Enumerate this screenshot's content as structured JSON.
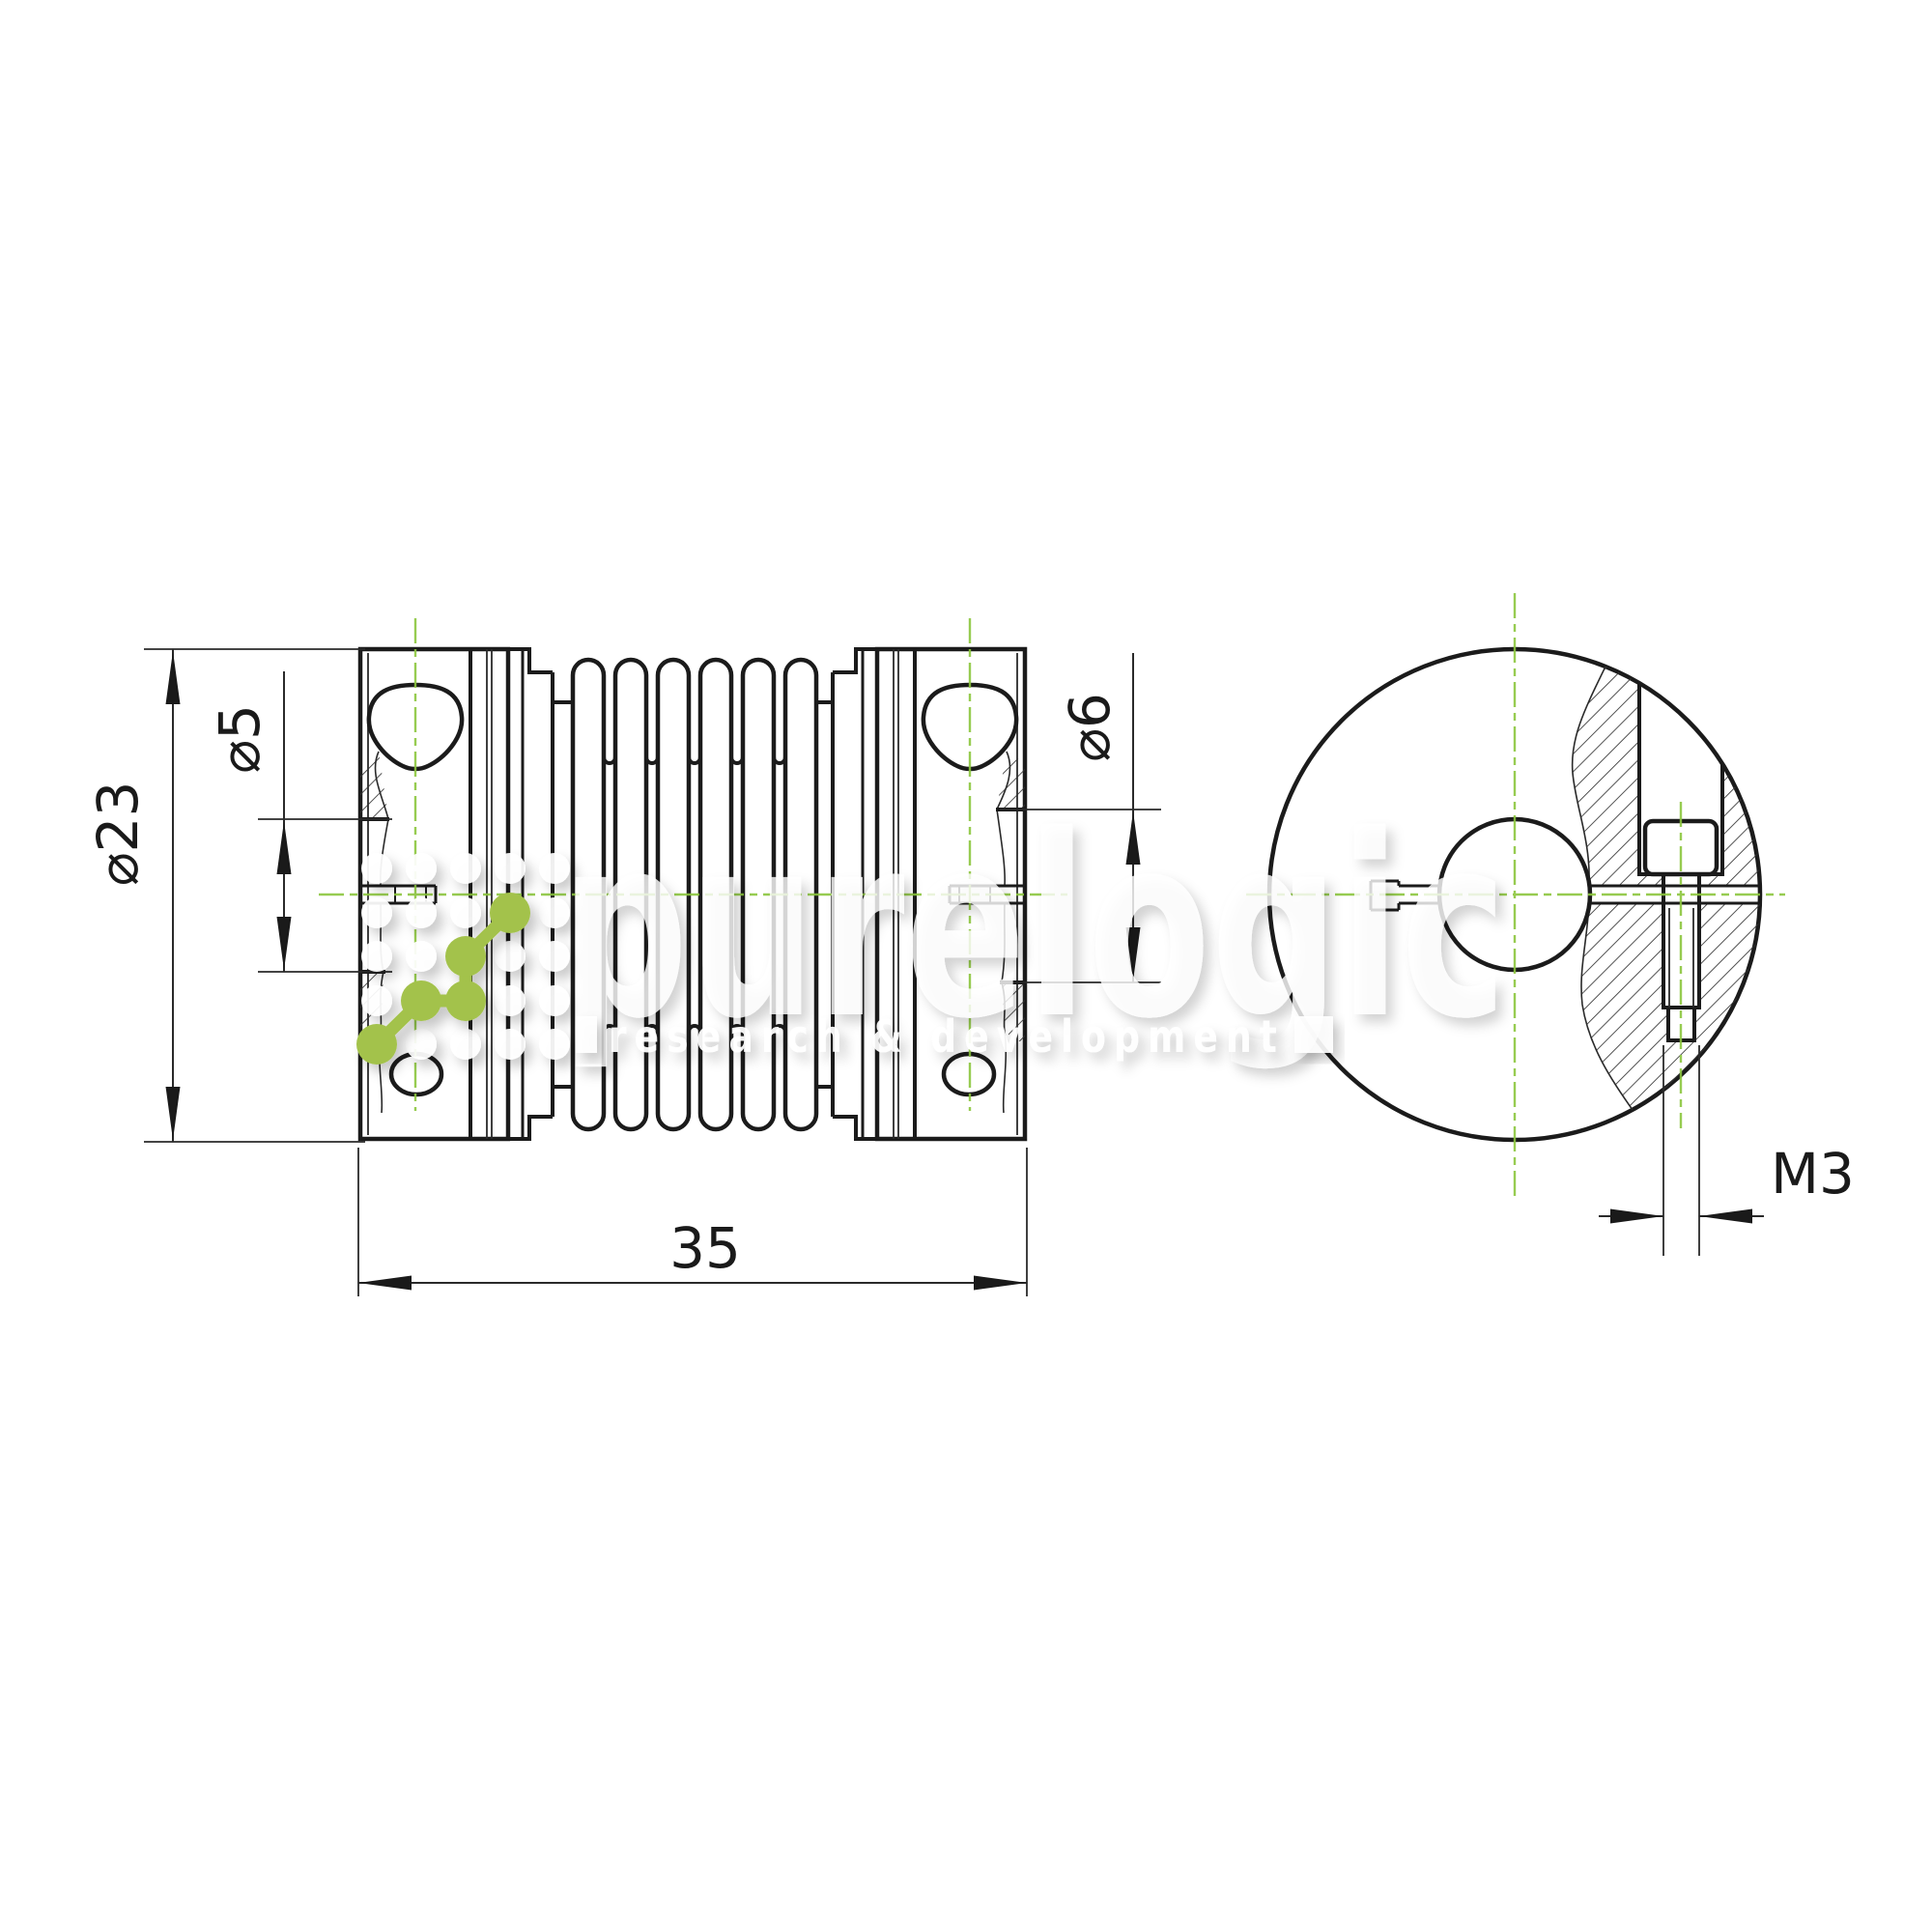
{
  "drawing": {
    "title": "bellows-coupling-technical-drawing",
    "views": {
      "side": "side view",
      "end": "end view"
    },
    "dimensions": {
      "outer_diameter": "⌀23",
      "left_bore": "⌀5",
      "right_bore": "⌀6",
      "length": "35",
      "clamp_screw_thread": "M3"
    },
    "colors": {
      "line": "#1b1b1b",
      "centerline_green": "#8cc63e",
      "logo_green": "#a3c24b"
    }
  },
  "watermark": {
    "brand": "purelogic",
    "tagline": "research & development"
  }
}
